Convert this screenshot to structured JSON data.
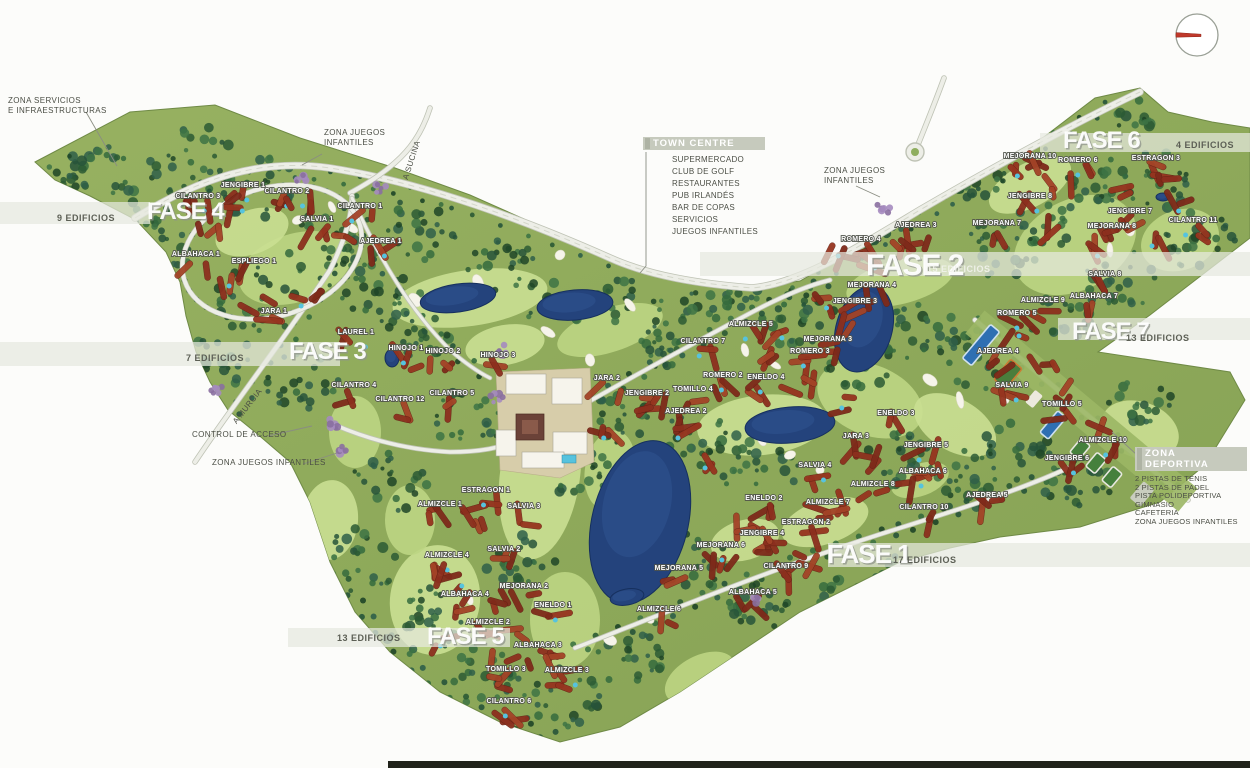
{
  "map_title": "Golf resort master plan",
  "colors": {
    "grass": "#86a254",
    "grass_light": "#97b161",
    "fairway": "#bdd583",
    "fairway2": "#cadf92",
    "forest": [
      "#1e4527",
      "#2b5a34",
      "#356b3d",
      "#27543a",
      "#3d7344",
      "#2f5f49"
    ],
    "building_red": [
      "#96341f",
      "#8c2f1e",
      "#a34327",
      "#7e2a1a"
    ],
    "road": "#edeee7",
    "road_edge": "#bfc3b5",
    "lake": "#24437c",
    "lake_edge": "#16305e",
    "pool": "#56c3de",
    "band": "#e6e9df",
    "label_halo": "#50534b",
    "watermark": "#ffffff",
    "compass_needle": "#c0392b",
    "text_gray": "#4b4e45"
  },
  "area_labels": {
    "zona_servicios": {
      "line1": "ZONA SERVICIOS",
      "line2": "E INFRAESTRUCTURAS"
    },
    "zona_juegos_top": {
      "line1": "ZONA JUEGOS",
      "line2": "INFANTILES"
    },
    "zona_juegos_right": {
      "line1": "ZONA JUEGOS",
      "line2": "INFANTILES"
    },
    "control_acceso": {
      "text": "CONTROL DE ACCESO"
    },
    "zona_juegos_bottom": {
      "text": "ZONA JUEGOS INFANTILES"
    },
    "road_a_sucina": "A SUCINA",
    "road_a_murcia": "A MURCIA"
  },
  "callouts": {
    "town_centre": {
      "title": "TOWN CENTRE",
      "items": [
        "SUPERMERCADO",
        "CLUB DE GOLF",
        "RESTAURANTES",
        "PUB IRLANDÉS",
        "BAR DE COPAS",
        "SERVICIOS",
        "JUEGOS INFANTILES"
      ]
    },
    "zona_deportiva": {
      "title": "ZONA DEPORTIVA",
      "items": [
        "2 PISTAS DE TENIS",
        "2 PISTAS DE PADEL",
        "PISTA POLIDEPORTIVA",
        "GIMNASIO",
        "CAFETERIA",
        "ZONA JUEGOS INFANTILES"
      ]
    }
  },
  "phases": [
    {
      "label": "FASE 4",
      "x": 147,
      "y": 219,
      "size": 24,
      "edificios": "9 EDIFICIOS",
      "ex": 57,
      "ey": 221,
      "light": false
    },
    {
      "label": "FASE 3",
      "x": 289,
      "y": 359,
      "size": 24,
      "edificios": "7 EDIFICIOS",
      "ex": 186,
      "ey": 361,
      "light": false
    },
    {
      "label": "FASE 2",
      "x": 866,
      "y": 275,
      "size": 30,
      "edificios": "15 EDIFICIOS",
      "ex": 927,
      "ey": 272,
      "light": true
    },
    {
      "label": "FASE 6",
      "x": 1063,
      "y": 148,
      "size": 24,
      "edificios": "4 EDIFICIOS",
      "ex": 1176,
      "ey": 148,
      "light": false
    },
    {
      "label": "FASE 7",
      "x": 1072,
      "y": 339,
      "size": 24,
      "edificios": "13 EDIFICIOS",
      "ex": 1126,
      "ey": 341,
      "light": false
    },
    {
      "label": "FASE 1",
      "x": 827,
      "y": 563,
      "size": 26,
      "edificios": "17 EDIFICIOS",
      "ex": 893,
      "ey": 563,
      "light": false
    },
    {
      "label": "FASE 5",
      "x": 427,
      "y": 644,
      "size": 24,
      "edificios": "13 EDIFICIOS",
      "ex": 337,
      "ey": 641,
      "light": false
    }
  ],
  "buildings": [
    {
      "label": "JENGIBRE 1",
      "x": 243,
      "y": 185
    },
    {
      "label": "CILANTRO 3",
      "x": 198,
      "y": 196
    },
    {
      "label": "CILANTRO 2",
      "x": 287,
      "y": 191
    },
    {
      "label": "CILANTRO 1",
      "x": 360,
      "y": 206
    },
    {
      "label": "SALVIA 1",
      "x": 317,
      "y": 219
    },
    {
      "label": "AJEDREA 1",
      "x": 381,
      "y": 241
    },
    {
      "label": "ALBAHACA 1",
      "x": 196,
      "y": 254
    },
    {
      "label": "ESPLIEGO 1",
      "x": 254,
      "y": 261
    },
    {
      "label": "JARA 1",
      "x": 274,
      "y": 311
    },
    {
      "label": "LAUREL 1",
      "x": 356,
      "y": 332
    },
    {
      "label": "HINOJO 1",
      "x": 406,
      "y": 348
    },
    {
      "label": "HINOJO 2",
      "x": 443,
      "y": 351
    },
    {
      "label": "HINOJO 3",
      "x": 498,
      "y": 355
    },
    {
      "label": "CILANTRO 4",
      "x": 354,
      "y": 385
    },
    {
      "label": "CILANTRO 12",
      "x": 400,
      "y": 399
    },
    {
      "label": "CILANTRO 5",
      "x": 452,
      "y": 393
    },
    {
      "label": "JARA 2",
      "x": 607,
      "y": 378
    },
    {
      "label": "JENGIBRE 2",
      "x": 647,
      "y": 393
    },
    {
      "label": "AJEDREA 2",
      "x": 686,
      "y": 411
    },
    {
      "label": "TOMILLO 4",
      "x": 693,
      "y": 389
    },
    {
      "label": "ROMERO 2",
      "x": 723,
      "y": 375
    },
    {
      "label": "ENELDO 4",
      "x": 766,
      "y": 377
    },
    {
      "label": "CILANTRO 7",
      "x": 703,
      "y": 341
    },
    {
      "label": "ALMIZCLE 5",
      "x": 751,
      "y": 324
    },
    {
      "label": "MEJORANA 3",
      "x": 828,
      "y": 339
    },
    {
      "label": "ROMERO 3",
      "x": 810,
      "y": 351
    },
    {
      "label": "MEJORANA 4",
      "x": 872,
      "y": 285
    },
    {
      "label": "JENGIBRE 3",
      "x": 855,
      "y": 301
    },
    {
      "label": "ROMERO 4",
      "x": 861,
      "y": 239
    },
    {
      "label": "AJEDREA 3",
      "x": 916,
      "y": 225
    },
    {
      "label": "ALMIZCLE 9",
      "x": 1043,
      "y": 300
    },
    {
      "label": "ROMERO 5",
      "x": 1017,
      "y": 313
    },
    {
      "label": "AJEDREA 4",
      "x": 998,
      "y": 351
    },
    {
      "label": "ENELDO 3",
      "x": 896,
      "y": 413
    },
    {
      "label": "MEJORANA 7",
      "x": 997,
      "y": 223
    },
    {
      "label": "MEJORANA 10",
      "x": 1030,
      "y": 156
    },
    {
      "label": "ROMERO 6",
      "x": 1078,
      "y": 160
    },
    {
      "label": "ESTRAGON 3",
      "x": 1156,
      "y": 158
    },
    {
      "label": "JENGIBRE 8",
      "x": 1030,
      "y": 196
    },
    {
      "label": "JENGIBRE 7",
      "x": 1130,
      "y": 211
    },
    {
      "label": "MEJORANA 8",
      "x": 1112,
      "y": 226
    },
    {
      "label": "CILANTRO 11",
      "x": 1193,
      "y": 220
    },
    {
      "label": "SALVIA 8",
      "x": 1105,
      "y": 274
    },
    {
      "label": "ALBAHACA 7",
      "x": 1094,
      "y": 296
    },
    {
      "label": "SALVIA 9",
      "x": 1012,
      "y": 385
    },
    {
      "label": "TOMILLO 5",
      "x": 1062,
      "y": 404
    },
    {
      "label": "ALMIZCLE 10",
      "x": 1103,
      "y": 440
    },
    {
      "label": "JENGIBRE 6",
      "x": 1067,
      "y": 458
    },
    {
      "label": "JARA 3",
      "x": 856,
      "y": 436
    },
    {
      "label": "JENGIBRE 5",
      "x": 926,
      "y": 445
    },
    {
      "label": "SALVIA 4",
      "x": 815,
      "y": 465
    },
    {
      "label": "ALBAHACA 6",
      "x": 923,
      "y": 471
    },
    {
      "label": "ALMIZCLE 8",
      "x": 873,
      "y": 484
    },
    {
      "label": "ENELDO 2",
      "x": 764,
      "y": 498
    },
    {
      "label": "ALMIZCLE 7",
      "x": 828,
      "y": 502
    },
    {
      "label": "CILANTRO 10",
      "x": 924,
      "y": 507
    },
    {
      "label": "AJEDREA 5",
      "x": 987,
      "y": 495
    },
    {
      "label": "ESTRAGON 2",
      "x": 806,
      "y": 522
    },
    {
      "label": "JENGIBRE 4",
      "x": 762,
      "y": 533
    },
    {
      "label": "MEJORANA 6",
      "x": 721,
      "y": 545
    },
    {
      "label": "CILANTRO 9",
      "x": 786,
      "y": 566
    },
    {
      "label": "ALBAHACA 5",
      "x": 753,
      "y": 592
    },
    {
      "label": "MEJORANA 5",
      "x": 679,
      "y": 568
    },
    {
      "label": "ALMIZCLE 6",
      "x": 659,
      "y": 609
    },
    {
      "label": "ESTRAGON 1",
      "x": 486,
      "y": 490
    },
    {
      "label": "ALMIZCLE 1",
      "x": 440,
      "y": 504
    },
    {
      "label": "SALVIA 3",
      "x": 524,
      "y": 506
    },
    {
      "label": "SALVIA 2",
      "x": 504,
      "y": 549
    },
    {
      "label": "ALMIZCLE 4",
      "x": 447,
      "y": 555
    },
    {
      "label": "MEJORANA 2",
      "x": 524,
      "y": 586
    },
    {
      "label": "ALBAHACA 4",
      "x": 465,
      "y": 594
    },
    {
      "label": "ENELDO 1",
      "x": 553,
      "y": 605
    },
    {
      "label": "ALMIZCLE 2",
      "x": 488,
      "y": 622
    },
    {
      "label": "ALBAHACA 3",
      "x": 538,
      "y": 645
    },
    {
      "label": "TOMILLO 3",
      "x": 506,
      "y": 669
    },
    {
      "label": "ALMIZCLE 3",
      "x": 567,
      "y": 670
    },
    {
      "label": "CILANTRO 6",
      "x": 509,
      "y": 701
    }
  ]
}
